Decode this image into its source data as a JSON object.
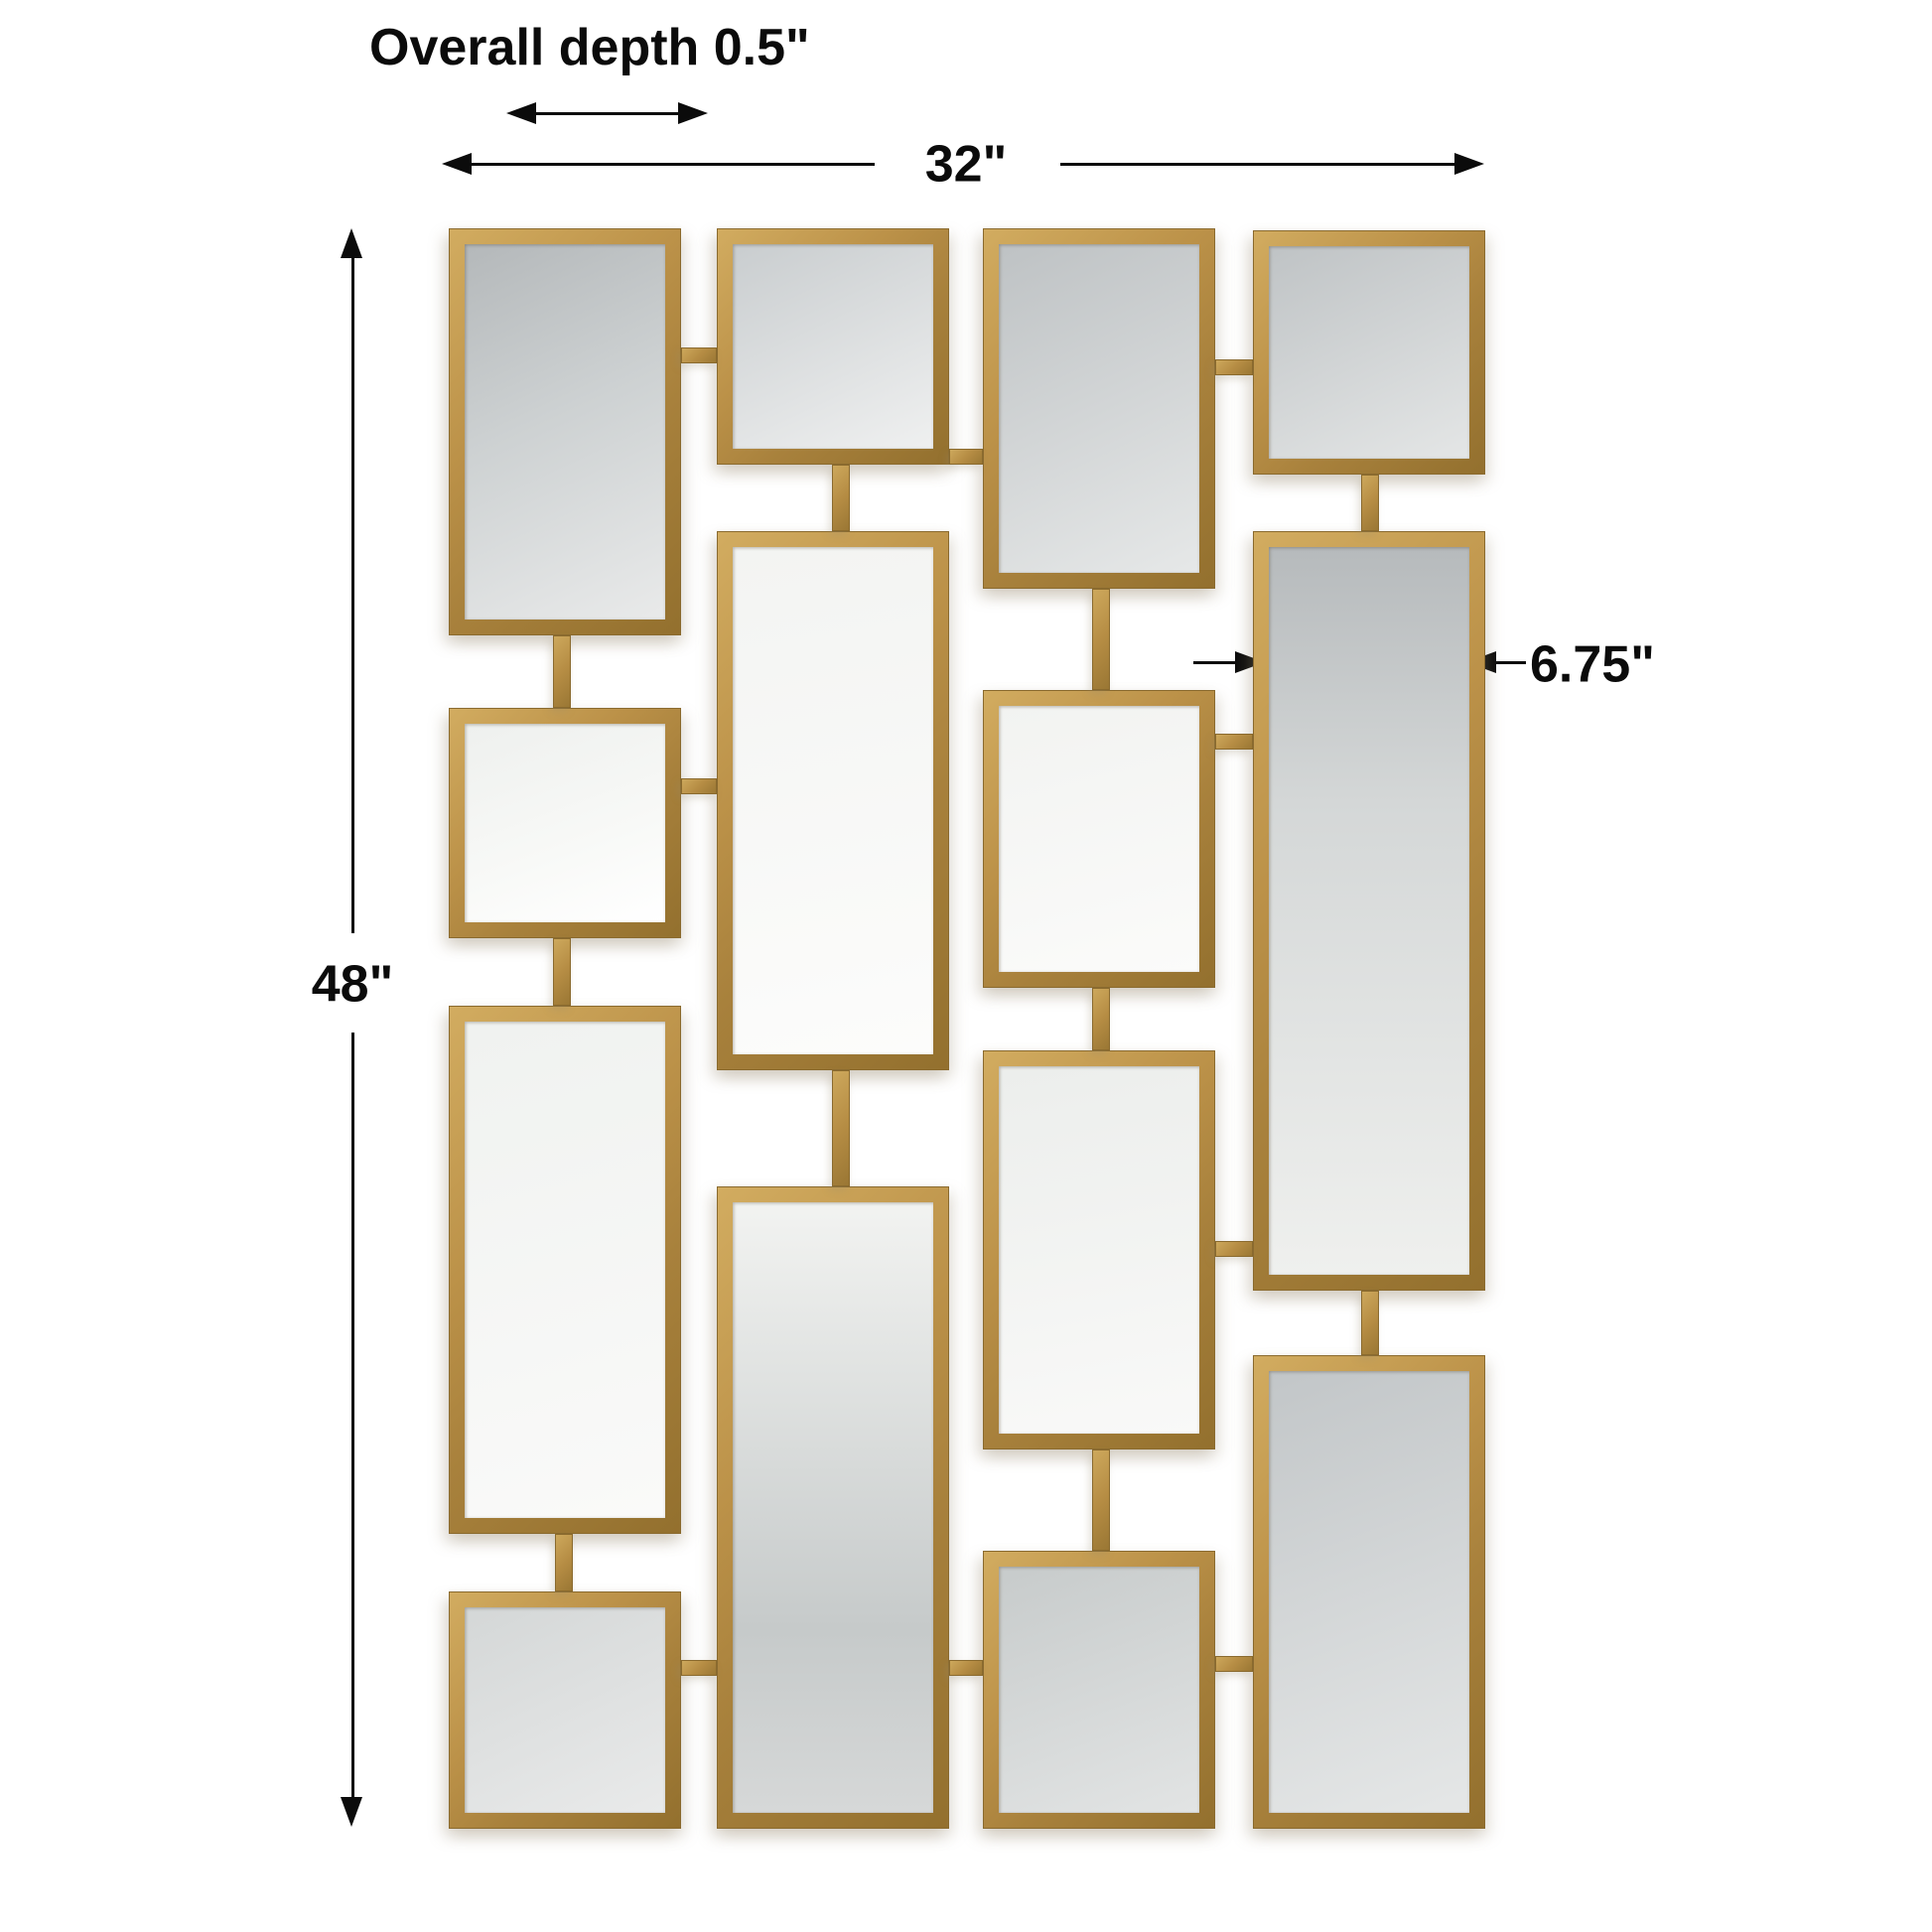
{
  "page": {
    "background": "#ffffff",
    "description": "Dimension drawing of a 14-panel rectangular gold wall mirror set"
  },
  "annotations": {
    "overall_depth": "Overall depth 0.5\"",
    "overall_width": "32\"",
    "overall_height": "48\"",
    "panel_height": "23.5\"",
    "panel_width": "6.75\""
  },
  "colors": {
    "frame_gold": "#b5904a",
    "frame_gold_light": "#d2ac60",
    "frame_gold_dark": "#8a6a2e",
    "dimension_ink": "#0b0b0b",
    "glass_gray": "#c3c7c9",
    "glass_light": "#f5f6f4"
  },
  "structure": {
    "mirror_count": 14,
    "columns": 4
  }
}
